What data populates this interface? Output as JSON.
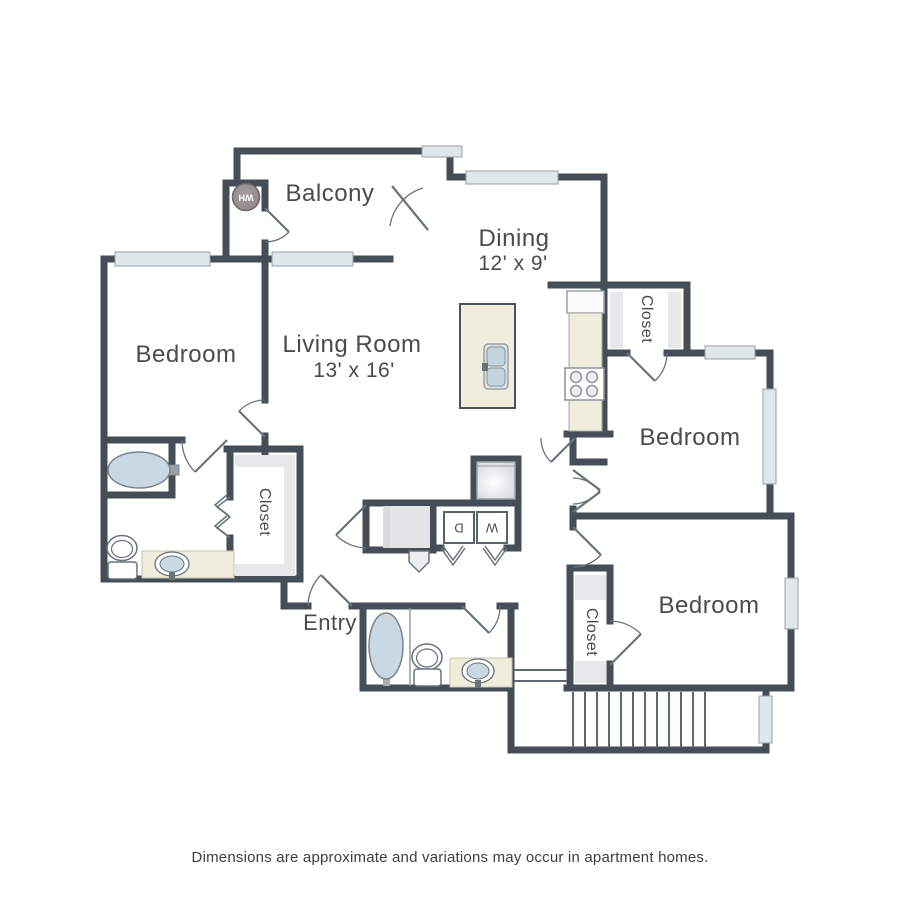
{
  "floorplan": {
    "rooms": {
      "balcony": {
        "label": "Balcony"
      },
      "dining": {
        "label": "Dining",
        "dims": "12' x 9'"
      },
      "living": {
        "label": "Living Room",
        "dims": "13' x 16'"
      },
      "bedroom_left": {
        "label": "Bedroom"
      },
      "bedroom_top_right": {
        "label": "Bedroom"
      },
      "bedroom_bottom_right": {
        "label": "Bedroom"
      },
      "entry": {
        "label": "Entry"
      },
      "closet_hall": {
        "label": "Closet"
      },
      "closet_top_right": {
        "label": "Closet"
      },
      "closet_bottom_right": {
        "label": "Closet"
      }
    },
    "appliances": {
      "washer": "W",
      "dryer": "D",
      "water_heater": "WH"
    },
    "colors": {
      "wall": "#454e57",
      "window_fill": "#dfe7eb",
      "counter_beige": "#efeddc",
      "fixture_blue": "#c9d8e2",
      "shelf_gray": "#e6e8ea",
      "door_line": "#6a727a",
      "text": "#4b4b4e"
    },
    "footer": "Dimensions are approximate and variations may occur in apartment homes."
  }
}
